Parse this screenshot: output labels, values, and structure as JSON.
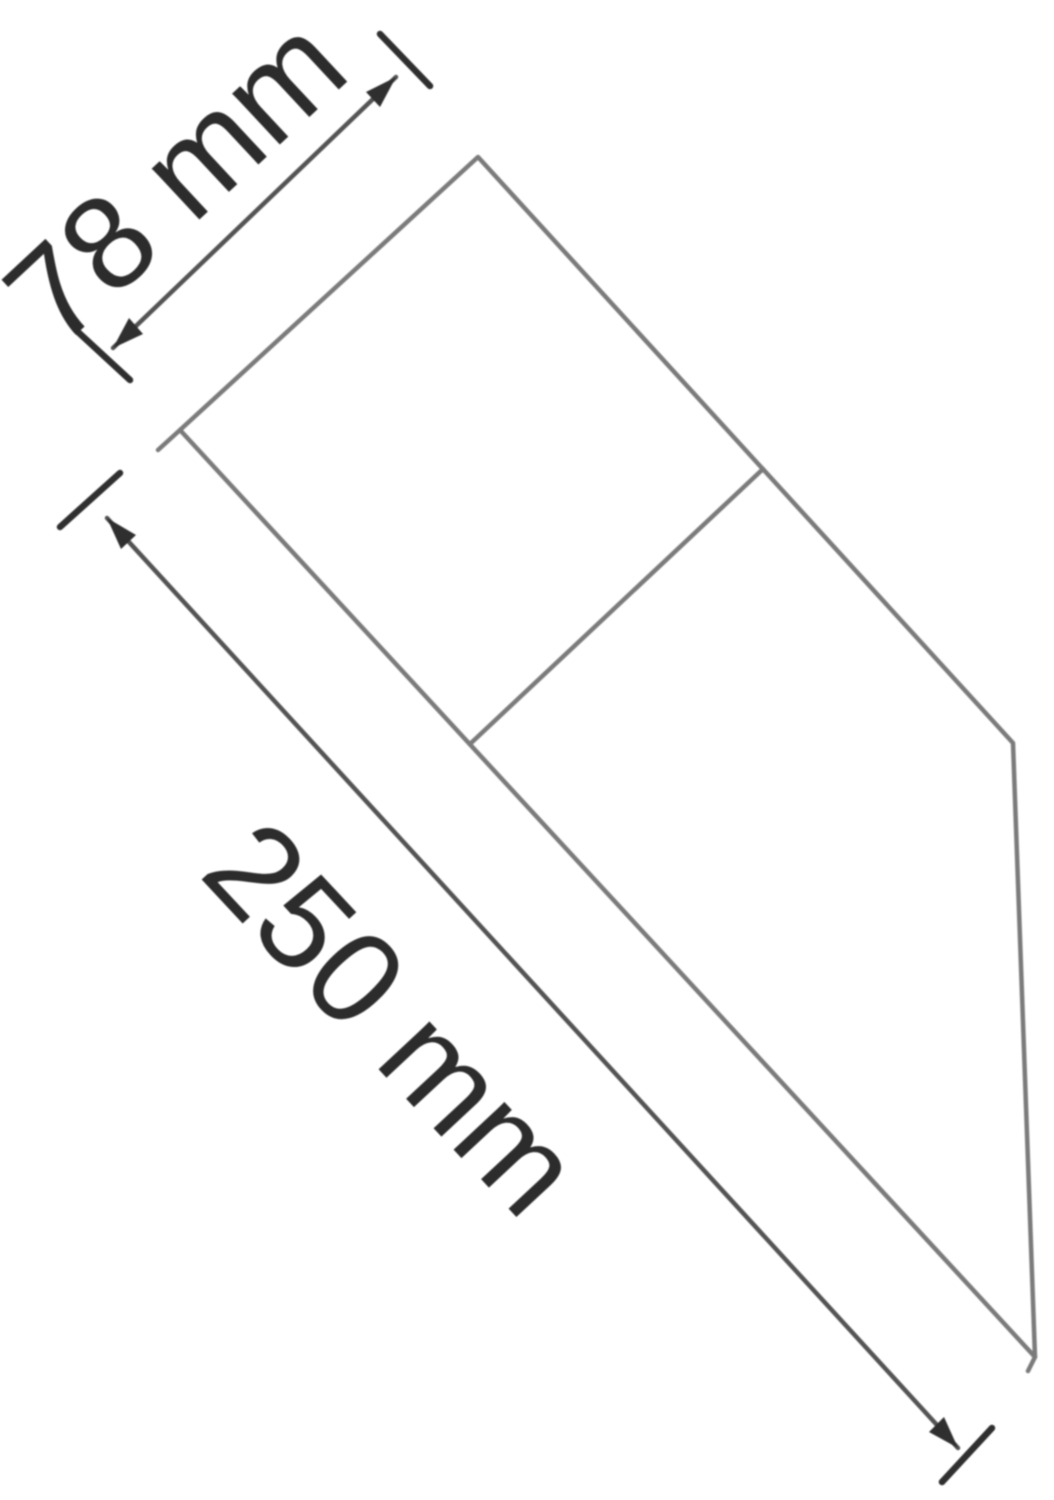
{
  "diagram": {
    "type": "technical-dimension-drawing",
    "dimensions": [
      {
        "id": "width",
        "label": "78 mm",
        "value": 78,
        "unit": "mm"
      },
      {
        "id": "length",
        "label": "250 mm",
        "value": 250,
        "unit": "mm"
      }
    ],
    "colors": {
      "background": "#ffffff",
      "outline": "#7b7b7b",
      "dimension_line": "#545454",
      "marker": "#2f2f2f",
      "label_text": "#2c2c2c"
    }
  }
}
